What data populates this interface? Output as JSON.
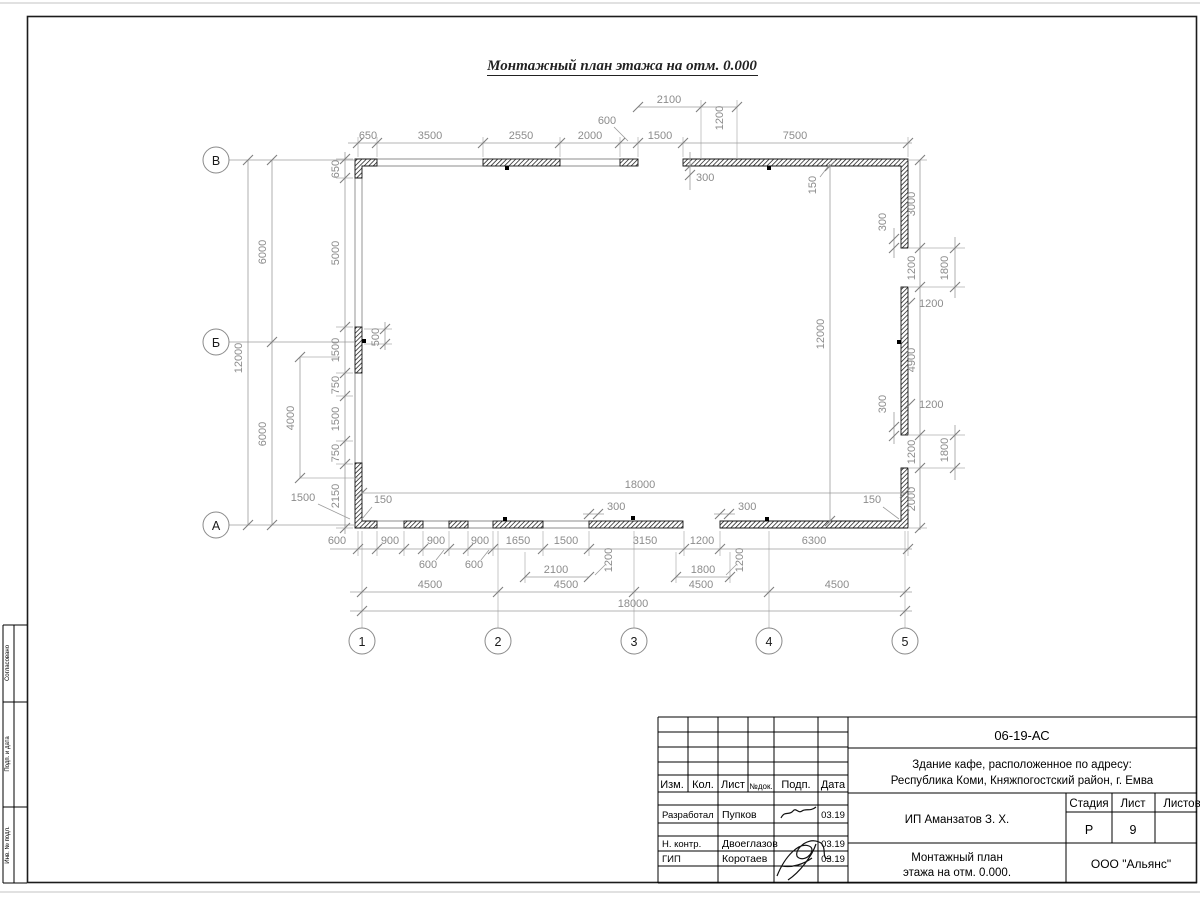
{
  "sheet": {
    "title": "Монтажный план этажа на отм. 0.000"
  },
  "axes": {
    "cols": [
      "1",
      "2",
      "3",
      "4",
      "5"
    ],
    "rows": [
      "В",
      "Б",
      "А"
    ]
  },
  "dims": {
    "top": [
      "650",
      "3500",
      "2550",
      "2000",
      "1500",
      "7500"
    ],
    "top2": [
      "600",
      "2100",
      "1200",
      "300",
      "150",
      "300"
    ],
    "right": [
      "3000",
      "1200",
      "1800",
      "1200",
      "4900",
      "300",
      "1200",
      "1200",
      "1800",
      "2000"
    ],
    "left": [
      "12000",
      "6000",
      "6000"
    ],
    "leftin": [
      "650",
      "5000",
      "1500",
      "750",
      "1500",
      "750",
      "2150"
    ],
    "leftx": [
      "4000",
      "1500",
      "500"
    ],
    "binner": [
      "18000",
      "150",
      "300",
      "300",
      "150"
    ],
    "bottom": [
      "600",
      "900",
      "900",
      "900",
      "1650",
      "1500",
      "3150",
      "1200",
      "6300"
    ],
    "bottom2": [
      "600",
      "600",
      "1200",
      "2100",
      "1200",
      "1800"
    ],
    "bottom3": [
      "4500",
      "4500",
      "4500",
      "4500"
    ],
    "bottom4": [
      "18000"
    ],
    "inner": [
      "12000"
    ]
  },
  "titleblock": {
    "doc_number": "06-19-АС",
    "project_line1": "Здание кафе, расположенное по адресу:",
    "project_line2": "Республика Коми, Княжпогостский район, г. Емва",
    "client": "ИП Аманзатов З. Х.",
    "header": [
      "Изм.",
      "Кол.",
      "Лист",
      "№док.",
      "Подп.",
      "Дата"
    ],
    "roles": [
      "Разработал",
      "Н. контр.",
      "ГИП"
    ],
    "names": [
      "Пупков",
      "Двоеглазов",
      "Коротаев"
    ],
    "dates": [
      "03.19",
      "03.19",
      "03.19"
    ],
    "stage_header": [
      "Стадия",
      "Лист",
      "Листов"
    ],
    "stage": "Р",
    "sheet_no": "9",
    "title_line1": "Монтажный план",
    "title_line2": "этажа на отм. 0.000.",
    "org": "ООО \"Альянс\""
  },
  "margin": [
    "Согласовано",
    "Подп. и дата",
    "Инв. № подл."
  ]
}
